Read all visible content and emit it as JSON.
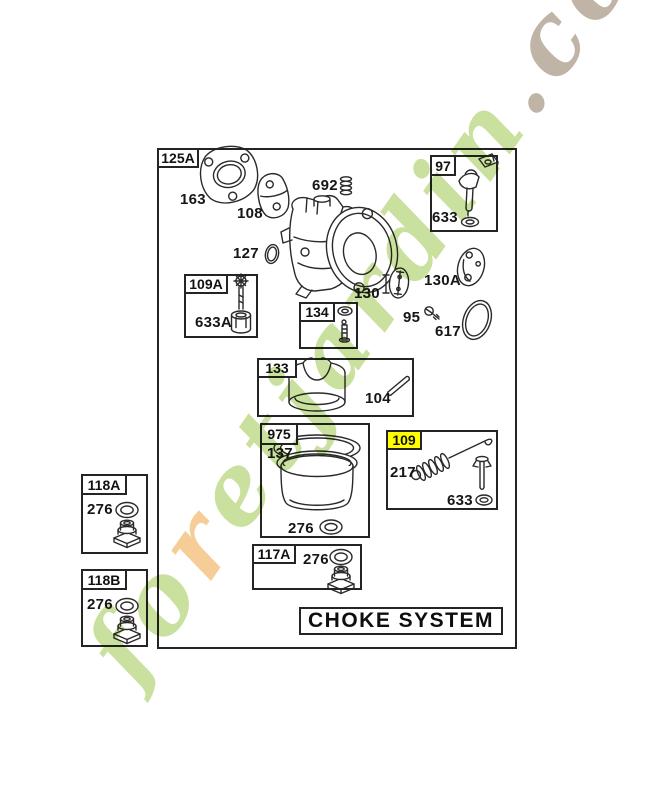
{
  "diagram": {
    "system_title": "CHOKE SYSTEM",
    "callouts": {
      "c125A": "125A",
      "c97": "97",
      "c109A": "109A",
      "c134": "134",
      "c133": "133",
      "c975": "975",
      "c109": "109",
      "c117A": "117A",
      "c118A": "118A",
      "c118B": "118B"
    },
    "highlight": {
      "callout": "109",
      "color": "#ffff00"
    },
    "part_numbers": {
      "n163": "163",
      "n108": "108",
      "n692": "692",
      "n127": "127",
      "n130": "130",
      "n130A": "130A",
      "n95": "95",
      "n617": "617",
      "n633_in_97": "633",
      "n633A": "633A",
      "n104": "104",
      "n137": "137",
      "n276_in_975": "276",
      "n217": "217",
      "n633_in_109": "633",
      "n276_in_117A": "276",
      "n276_in_118A": "276",
      "n276_in_118B": "276"
    }
  },
  "watermark": {
    "full_text": "foretjardin.com",
    "segments": [
      {
        "text": "fo",
        "color": "#c5dd94"
      },
      {
        "text": "r",
        "color": "#f6c88c"
      },
      {
        "text": "etjardin",
        "color": "#c5dd94"
      },
      {
        "text": ".com",
        "color": "#b9ac9d"
      }
    ]
  },
  "colors": {
    "line": "#2a2a2a",
    "background": "#ffffff",
    "label_text": "#111111"
  }
}
